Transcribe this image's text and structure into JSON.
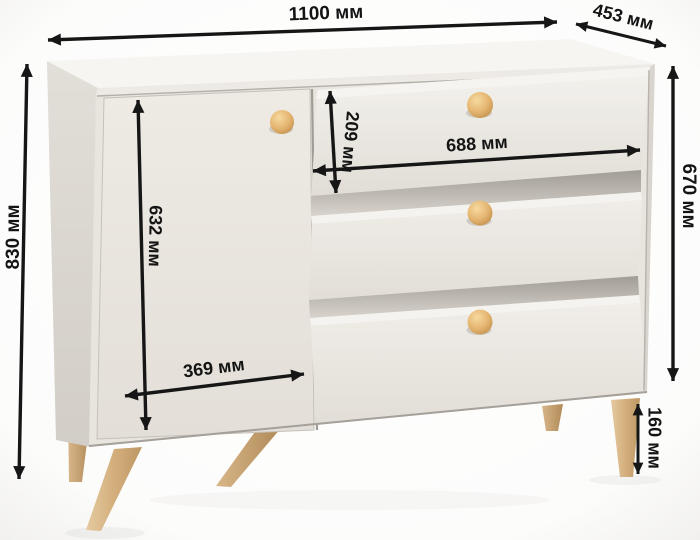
{
  "diagram": {
    "subject": "chest-of-drawers-dimensions",
    "unit": "мм",
    "dimensions": {
      "width": "1100 мм",
      "depth": "453 мм",
      "height": "830 мм",
      "front_height": "670 мм",
      "door_height": "632 мм",
      "top_drawer_height": "209 мм",
      "drawer_width": "688 мм",
      "door_width": "369 мм",
      "leg_height": "160 мм"
    },
    "colors": {
      "arrow": "#161616",
      "label_text": "#141414",
      "top_face": "#f7f5f1",
      "front_face": "#eae6e0",
      "side_face": "#d8d4cd",
      "drawer_lip": "#f6f4f0",
      "shadow_band": "#a8a49d",
      "knob_wood": "#e2b26c",
      "leg_wood": "#d3b183",
      "background": "#fdfdfc"
    }
  }
}
